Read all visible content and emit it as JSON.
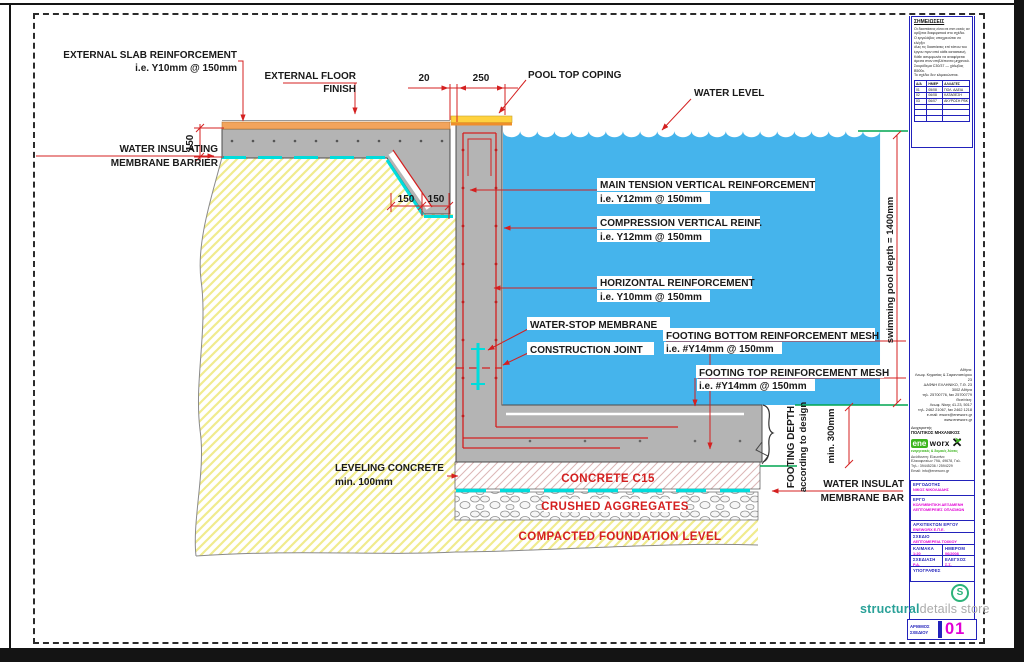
{
  "drawing": {
    "labels": {
      "ext_slab_1": "EXTERNAL SLAB REINFORCEMENT",
      "ext_slab_2": "i.e. Y10mm @ 150mm",
      "ext_floor_1": "EXTERNAL FLOOR",
      "ext_floor_2": "FINISH",
      "water_ins_1": "WATER INSULATING",
      "water_ins_2": "MEMBRANE BARRIER",
      "pool_top_coping": "POOL TOP COPING",
      "water_level": "WATER LEVEL",
      "main_tension_1": "MAIN TENSION VERTICAL REINFORCEMENT",
      "main_tension_2": "i.e. Y12mm @ 150mm",
      "compression_1": "COMPRESSION VERTICAL REINF.",
      "compression_2": "i.e. Y12mm @ 150mm",
      "horizontal_1": "HORIZONTAL REINFORCEMENT",
      "horizontal_2": "i.e. Y10mm @ 150mm",
      "water_stop": "WATER-STOP MEMBRANE",
      "construction_joint": "CONSTRUCTION JOINT",
      "footing_bottom_1": "FOOTING BOTTOM REINFORCEMENT MESH",
      "footing_bottom_2": "i.e. #Y14mm @ 150mm",
      "footing_top_1": "FOOTING TOP REINFORCEMENT MESH",
      "footing_top_2": "i.e. #Y14mm @ 150mm",
      "leveling_1": "LEVELING CONCRETE",
      "leveling_2": "min. 100mm",
      "concrete_c15": "CONCRETE C15",
      "crushed_aggregates": "CRUSHED AGGREGATES",
      "compacted": "COMPACTED FOUNDATION LEVEL",
      "water_ins_right_1": "WATER INSULAT",
      "water_ins_right_2": "MEMBRANE BAR",
      "pool_depth": "swimming pool depth = 1400mm",
      "footing_depth_1": "FOOTING DEPTH",
      "footing_depth_2": "according to design",
      "footing_depth_3": "min. 300mm"
    },
    "dims": {
      "d150_left": "150",
      "d20": "20",
      "d250": "250",
      "d150_a": "150",
      "d150_b": "150"
    },
    "colors": {
      "water": "#45b4ec",
      "concrete": "#b4b4b4",
      "accent_red": "#d42020",
      "membrane_cyan": "#00dcdc",
      "soil_hatch": "#f0eb8e",
      "finish_orange": "#f2a45c",
      "coping_yellow": "#ffd23e",
      "green_line": "#00a651",
      "blue_line": "#2222bb",
      "magenta": "#e100d5",
      "brand_teal": "#2aa198"
    }
  },
  "title_block": {
    "notes": {
      "header": "ΣΗΜΕΙΩΣΕΙΣ",
      "lines": [
        "Οι διαστάσεις είναι σε mm εκτός αν",
        "ορίζεται διαφορετικά στο σχέδιο.",
        "Ο εργολάβος υποχρεούται να ελέγξει",
        "όλες τις διαστάσεις επί τόπου του",
        "έργου πριν από κάθε κατασκευή.",
        "Κάθε ασυμφωνία να αναφέρεται",
        "άμεσα στον επιβλέποντα μηχανικό.",
        "Σκυρόδεμα C30/37 — χάλυβας B500c.",
        "Το σχέδιο δεν κλιμακώνεται."
      ]
    },
    "revisions": {
      "headers": [
        "Α/Α",
        "ΗΜΕΡ",
        "ΑΛΛΑΓΕΣ"
      ],
      "rows": [
        [
          "01",
          "05/08",
          "ΠΟΛ. ΑΔΕΙΑ"
        ],
        [
          "02",
          "06/08",
          "ΚΑΤΑΘΕΣΗ"
        ],
        [
          "03",
          "06/07",
          "ΑΚΥΡΩΣΗ ΡΒΚ"
        ]
      ]
    },
    "company": {
      "address_lines": [
        "Αθήνα:",
        "Λεωφ. Κηφισίας & Σαρανταπόρου 23",
        "ΔΑΦΝΗ ΕΛΛΗΝΙΚΟ, Τ.Θ. 23",
        "3002 Αθήνα",
        "τηλ. 25700776, fax 25700779",
        "Θεσ/νίκη:",
        "Λεωφ. Νίκης 41.23, 5017",
        "τηλ. 2462 21067, fax 2462 1218",
        "e-mail: eworx@eneworx.gr",
        "www.eneworx.gr"
      ],
      "manager_label": "Διαχειριστής",
      "manager_title": "ΠΟΛΙΤΙΚΟΣ ΜΗΧΑΝΙΚΟΣ",
      "logo_ene": "ene",
      "logo_worx": "worx",
      "logo_tagline": "ενεργειακές & δομικές λύσεις",
      "office_lines": [
        "Διεύθυνση: Ελευσίνα",
        "Ελαιοφυτείων 79Α, 49678, Γαλ.",
        "Τηλ.: 39445236 / 2594229",
        "Email: info@eneworx.gr"
      ]
    },
    "fields": {
      "ergodotis_label": "ΕΡΓΟΔΟΤΗΣ",
      "ergodotis_value": "ΝΙΚΟΣ ΝΙΚΟΛΑΙΔΗΣ",
      "ergo_label": "ΕΡΓΟ",
      "ergo_value_1": "ΚΟΛΥΜΒΗΤΙΚΗ ΔΕΞΑΜΕΝΗ",
      "ergo_value_2": "ΛΕΠΤΟΜΕΡΕΙΕΣ ΟΠΛΙΣΜΩΝ",
      "architect_label": "ΑΡΧΙΤΕΚΤΩΝ ΕΡΓΟΥ",
      "architect_value": "ΕΝΕWORX Ε.Π.Ε.",
      "sxedio_label": "ΣΧΕΔΙΟ",
      "sxedio_value": "ΛΕΠΤΟΜΕΡΕΙΑ ΤΟΙΧΙΟΥ ΠΙΣΙΝΑΣ",
      "klimaka_label": "ΚΛΙΜΑΚΑ",
      "klimaka_value": "1:20",
      "imerom_label": "ΗΜΕΡΟΜ",
      "imerom_value": "06/2008",
      "sxediasi_label": "ΣΧΕΔΙΑΣΗ",
      "sxediasi_value": "Ρ.Δ.",
      "elegxos_label": "ΕΛΕΓΧΟΣ",
      "elegxos_value": "Σ.Σ.",
      "ypografes_label": "ΥΠΟΓΡΑΦΕΣ"
    },
    "store": {
      "s_icon": "S",
      "brand_strong": "structural",
      "brand_light": "details store"
    },
    "number_box": {
      "label_1": "ΑΡΙΘΜΟΣ",
      "label_2": "ΣΧΕΔΙΟΥ",
      "value": "01"
    }
  }
}
